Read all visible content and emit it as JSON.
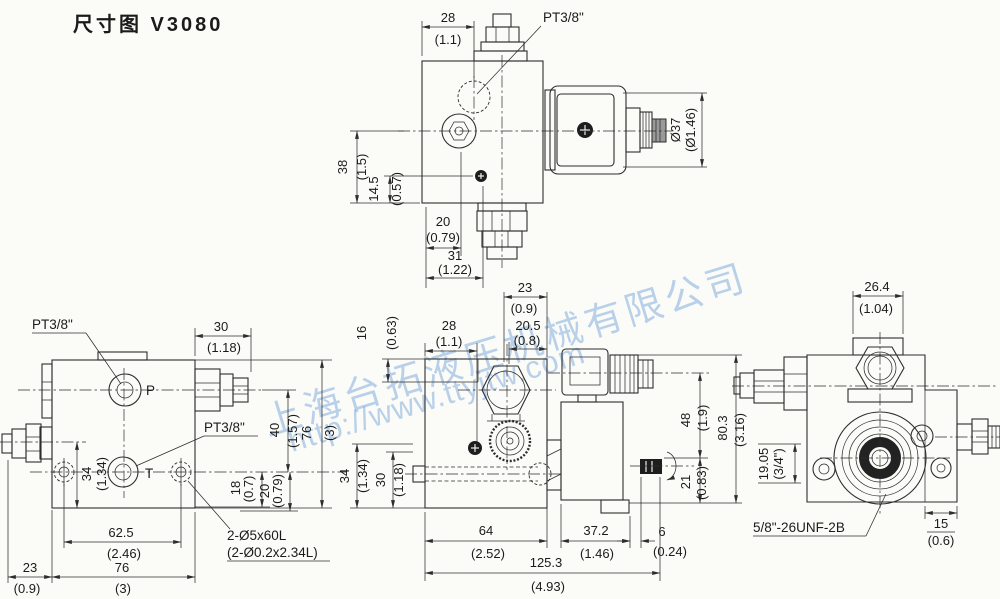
{
  "title": "尺寸图 V3080",
  "watermark": {
    "company": "上海台拓液压机械有限公司",
    "url": "http://www.ttyjtw.com",
    "color": "#7aa6dc"
  },
  "views": {
    "top": {
      "pt_label": "PT3/8\"",
      "w28": {
        "mm": "28",
        "in": "(1.1)"
      },
      "dia37": {
        "mm": "Ø37",
        "in": "(Ø1.46)"
      },
      "h38": {
        "mm": "38",
        "in": "(1.5)"
      },
      "h145": {
        "mm": "14.5",
        "in": "(0.57)"
      },
      "w20": {
        "mm": "20",
        "in": "(0.79)"
      },
      "w31": {
        "mm": "31",
        "in": "(1.22)"
      }
    },
    "left": {
      "pt_p": "PT3/8\"",
      "pt_t": "PT3/8\"",
      "port_p": "P",
      "port_t": "T",
      "holes_mm": "2-Ø5x60L",
      "holes_in": "(2-Ø0.2x2.34L)",
      "w30": {
        "mm": "30",
        "in": "(1.18)"
      },
      "h34": {
        "mm": "34",
        "in": "(1.34)"
      },
      "h18": {
        "mm": "18",
        "in": "(0.7)"
      },
      "h20": {
        "mm": "20",
        "in": "(0.79)"
      },
      "h40": {
        "mm": "40",
        "in": "(1.57)"
      },
      "h76": {
        "mm": "76",
        "in": "(3)"
      },
      "w625": {
        "mm": "62.5",
        "in": "(2.46)"
      },
      "w23": {
        "mm": "23",
        "in": "(0.9)"
      },
      "w76": {
        "mm": "76",
        "in": "(3)"
      }
    },
    "middle": {
      "w23": {
        "mm": "23",
        "in": "(0.9)"
      },
      "w205": {
        "mm": "20.5",
        "in": "(0.8)"
      },
      "w28": {
        "mm": "28",
        "in": "(1.1)"
      },
      "h16": {
        "mm": "16",
        "in": "(0.63)"
      },
      "h34": {
        "mm": "34",
        "in": "(1.34)"
      },
      "h30": {
        "mm": "30",
        "in": "(1.18)"
      },
      "h48": {
        "mm": "48",
        "in": "(1.9)"
      },
      "h803": {
        "mm": "80.3",
        "in": "(3.16)"
      },
      "h21": {
        "mm": "21",
        "in": "(0.83)"
      },
      "w64": {
        "mm": "64",
        "in": "(2.52)"
      },
      "w372": {
        "mm": "37.2",
        "in": "(1.46)"
      },
      "w6": {
        "mm": "6",
        "in": "(0.24)"
      },
      "w1253": {
        "mm": "125.3",
        "in": "(4.93)"
      }
    },
    "right": {
      "w264": {
        "mm": "26.4",
        "in": "(1.04)"
      },
      "h1905": {
        "mm": "19.05",
        "in": "(3/4\")"
      },
      "thread": "5/8\"-26UNF-2B",
      "w15": {
        "mm": "15",
        "in": "(0.6)"
      }
    }
  }
}
